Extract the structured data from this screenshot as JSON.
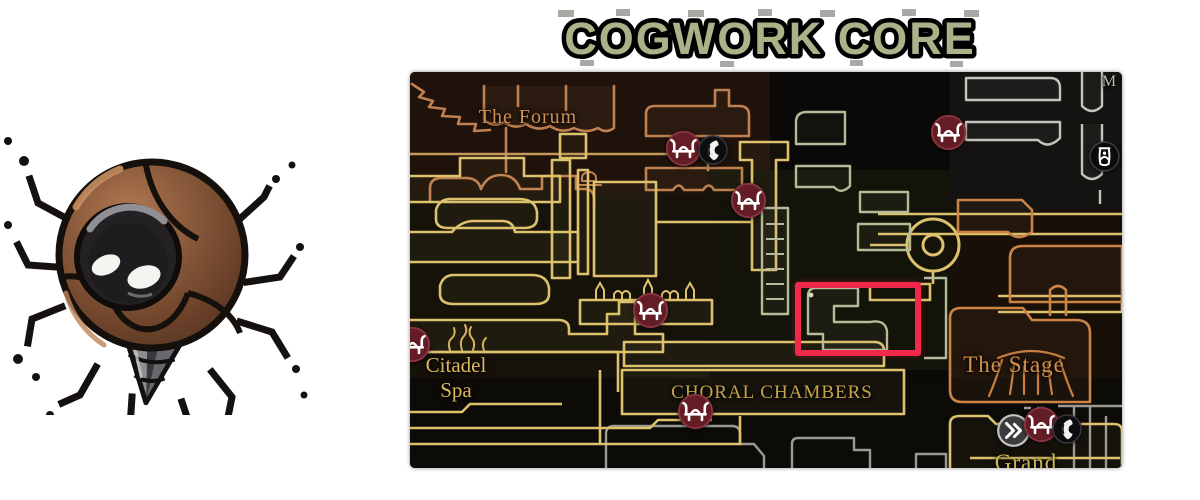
{
  "title": {
    "text": "COGWORK CORE",
    "color": "#a9b289"
  },
  "character": {
    "name": "cogwork-clapper-enemy"
  },
  "map": {
    "region_labels": [
      {
        "id": "the-forum",
        "text": "The Forum",
        "x": 118,
        "y": 33,
        "color": "#cf9053",
        "size": 20,
        "spacing": 1
      },
      {
        "id": "citadel-spa",
        "lines": [
          "Citadel",
          "Spa"
        ],
        "x": 46,
        "y": 281,
        "color": "#ddb85f",
        "size": 21,
        "spacing": 0
      },
      {
        "id": "choral-chambers",
        "text": "CHORAL CHAMBERS",
        "x": 362,
        "y": 310,
        "color": "#c7a44a",
        "size": 19,
        "spacing": 1
      },
      {
        "id": "the-stage",
        "text": "The Stage",
        "x": 604,
        "y": 279,
        "color": "#d28f4a",
        "size": 23,
        "spacing": 1
      },
      {
        "id": "grand",
        "text": "Grand",
        "x": 616,
        "y": 377,
        "color": "#d2b752",
        "size": 23,
        "spacing": 1
      },
      {
        "id": "edge-m",
        "text": "M",
        "x": 699,
        "y": 0,
        "color": "#b9b9ae",
        "size": 16,
        "spacing": 0
      }
    ],
    "markers": [
      {
        "type": "bench",
        "x": 273,
        "y": 76
      },
      {
        "type": "npc",
        "x": 303,
        "y": 78
      },
      {
        "type": "bench",
        "x": 338,
        "y": 128
      },
      {
        "type": "bench",
        "x": 538,
        "y": 60
      },
      {
        "type": "shrine",
        "x": 694,
        "y": 84
      },
      {
        "type": "bench",
        "x": 240,
        "y": 238
      },
      {
        "type": "bench",
        "x": 2,
        "y": 272
      },
      {
        "type": "bench",
        "x": 285,
        "y": 339
      },
      {
        "type": "travel",
        "x": 603,
        "y": 358
      },
      {
        "type": "bench",
        "x": 631,
        "y": 352
      },
      {
        "type": "npc",
        "x": 657,
        "y": 357
      }
    ],
    "highlight": {
      "x": 385,
      "y": 210,
      "w": 126,
      "h": 74,
      "color": "#f2284a",
      "border": 6
    }
  }
}
